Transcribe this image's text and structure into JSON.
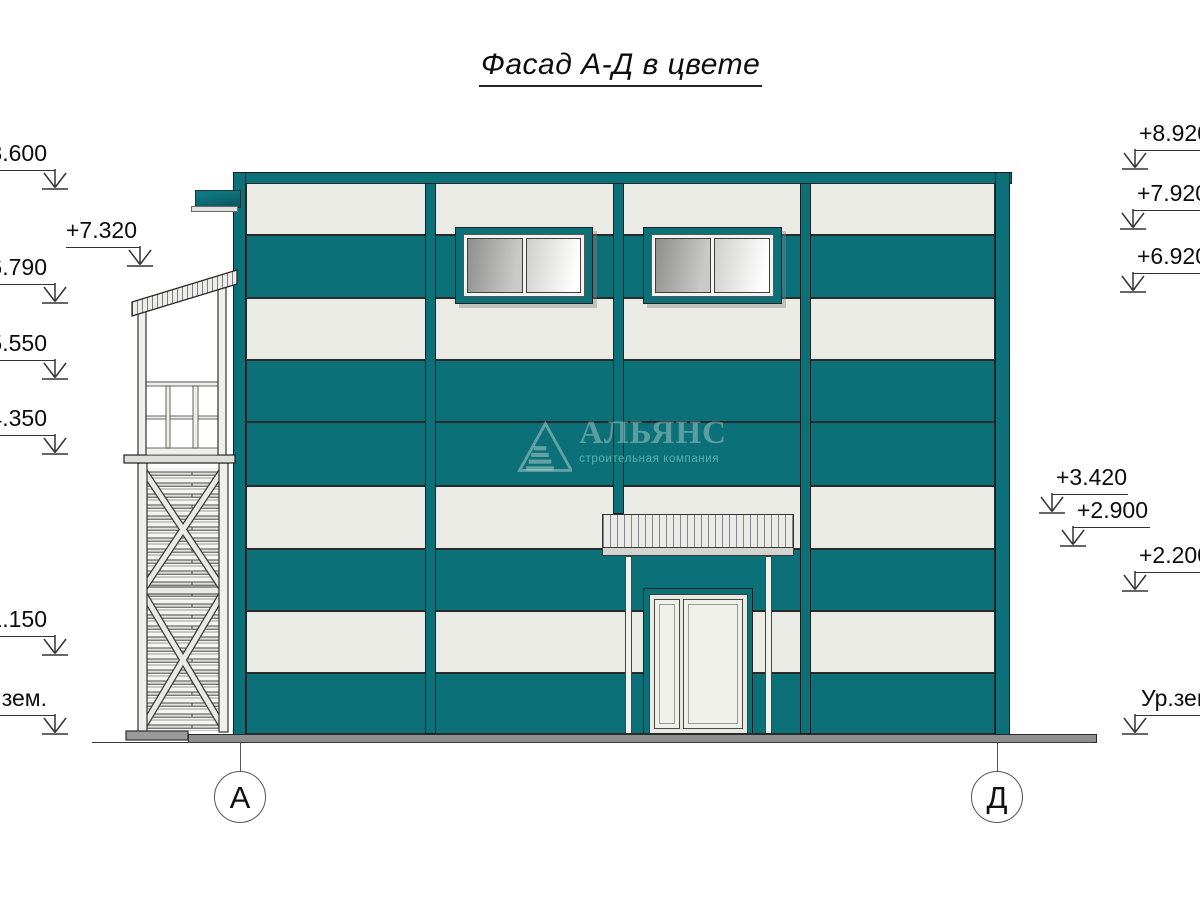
{
  "title": "Фасад А-Д в цвете",
  "elevation_marks": {
    "left": [
      {
        "label": "+8.600"
      },
      {
        "label": "+7.320"
      },
      {
        "label": "+6.790"
      },
      {
        "label": "+5.550"
      },
      {
        "label": "+4.350"
      },
      {
        "label": "+1.150"
      },
      {
        "label": "Ур.зем."
      }
    ],
    "right": [
      {
        "label": "+8.920"
      },
      {
        "label": "+7.920"
      },
      {
        "label": "+6.920"
      },
      {
        "label": "+3.420"
      },
      {
        "label": "+2.900"
      },
      {
        "label": "+2.200"
      },
      {
        "label": "Ур.зем."
      }
    ]
  },
  "axis_markers": [
    {
      "label": "А"
    },
    {
      "label": "Д"
    }
  ],
  "watermark": {
    "name": "АЛЬЯНС",
    "tagline": "строительная компания"
  },
  "colors": {
    "teal": "#0c7078",
    "teal_dark": "#09565e",
    "panel": "#ebebe5",
    "base_gray": "#8f8f8f"
  }
}
